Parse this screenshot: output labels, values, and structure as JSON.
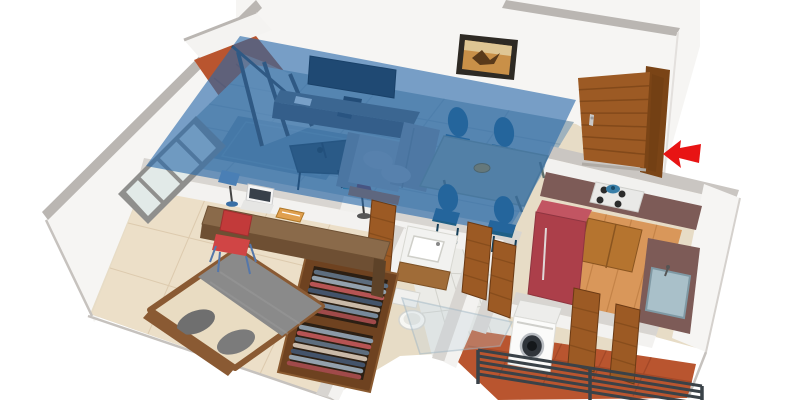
{
  "scene": {
    "type": "3d-isometric-floor-plan",
    "description": "3D rendered floor plan of a one-bedroom apartment; the living-dining area is highlighted with a translucent blue overlay and a red arrow marks the entrance door",
    "highlighted_room": "living-dining"
  },
  "rooms": [
    {
      "id": "living-dining",
      "label": "Living / Dining Area",
      "highlighted": true,
      "furniture": [
        "wall-tv",
        "tv-stand",
        "sofa",
        "coffee-table",
        "area-rug",
        "side-stool",
        "floor-lamp",
        "dining-table",
        "dining-chairs-x4",
        "fruit-bowl",
        "wall-art"
      ]
    },
    {
      "id": "balcony",
      "label": "Balcony",
      "highlighted": false,
      "furniture": [
        "sliding-glass-doors",
        "terracotta-floor"
      ]
    },
    {
      "id": "bedroom",
      "label": "Bedroom",
      "highlighted": false,
      "furniture": [
        "double-bed",
        "gray-blanket",
        "pillows-x2",
        "wood-bed-frame",
        "desk",
        "laptop",
        "desk-lamp",
        "books",
        "red-chair",
        "wardrobe-with-clothes",
        "four-pane-window"
      ]
    },
    {
      "id": "bathroom",
      "label": "Bathroom",
      "highlighted": false,
      "furniture": [
        "vanity-sink",
        "toilet",
        "glass-partition",
        "tiled-floor"
      ]
    },
    {
      "id": "kitchen",
      "label": "Kitchen",
      "highlighted": false,
      "furniture": [
        "red-refrigerator",
        "cooktop-with-pot",
        "wood-cabinets",
        "counter",
        "steel-sink"
      ]
    },
    {
      "id": "utility-balcony",
      "label": "Service Balcony",
      "highlighted": false,
      "furniture": [
        "washing-machine",
        "metal-railing",
        "terracotta-tiles",
        "wood-doors"
      ]
    },
    {
      "id": "entrance",
      "label": "Entrance",
      "highlighted": false,
      "furniture": [
        "wood-panel-door",
        "door-handle"
      ]
    }
  ],
  "annotations": {
    "entrance_arrow": {
      "shape": "left-arrow",
      "meaning": "entrance direction",
      "color": "#e81414"
    }
  },
  "counts": {
    "dining_chairs": 4,
    "window_panes": 4,
    "wardrobe_sections": 2
  },
  "colors": {
    "page_bg": "#ffffff",
    "overlay_blue": "rgba(40,105,170,0.62)",
    "arrow_red": "#e81414",
    "wall_white": "#f6f5f3",
    "wall_cap": "#bab6b2",
    "wall_cap_light": "#d8d5d1",
    "wall_face": "#f3f2f0",
    "wood_door": "#9c5a24",
    "wood_dark": "#6b3a14",
    "living_floor": "#9fb2bd",
    "rug": "#7390a2",
    "bedroom_floor": "#ecdfc8",
    "bathroom_floor": "#ebebe7",
    "kitchen_floor": "#d9975a",
    "terracotta": "#b9552f",
    "counter_mauve": "#7d5b57",
    "fridge_red": "#ac3f4a",
    "bed_blanket": "#8a8a8a",
    "bed_frame": "#8a5a33",
    "sofa_gray": "#9aa0aa",
    "chair_blue": "#1f5f86",
    "desk_wood": "#8a6a4a",
    "railing_dark": "#3a4248",
    "glass": "#e2eae8"
  }
}
